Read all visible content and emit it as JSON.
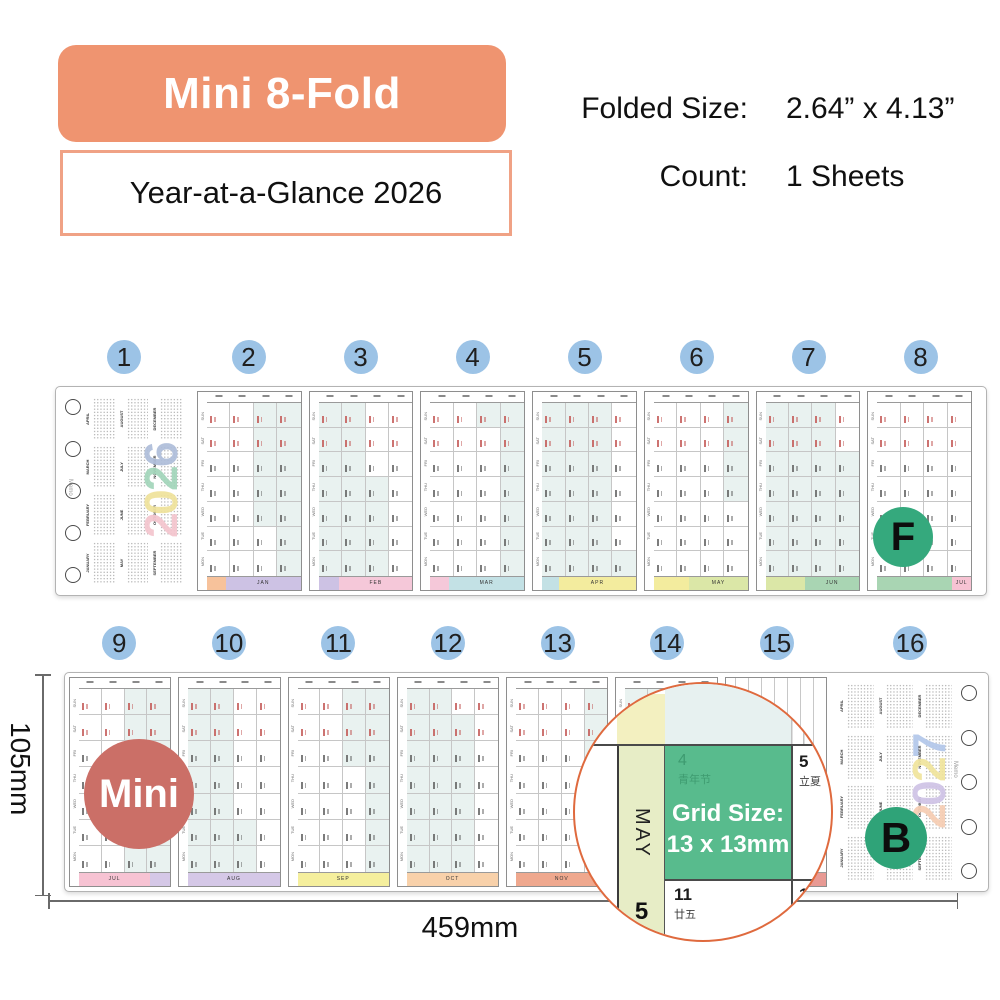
{
  "header": {
    "banner": "Mini 8-Fold",
    "subtitle": "Year-at-a-Glance 2026",
    "specs": [
      {
        "label": "Folded Size:",
        "value": "2.64” x 4.13”"
      },
      {
        "label": "Count:",
        "value": "1 Sheets"
      }
    ]
  },
  "annotations": {
    "product_label": "Mini",
    "dim_width": "459mm",
    "dim_height": "105mm"
  },
  "strips": {
    "front": {
      "side_label": "F",
      "memo": "Memo",
      "panel_numbers": [
        "1",
        "2",
        "3",
        "4",
        "5",
        "6",
        "7",
        "8"
      ],
      "day_labels": [
        "SUN",
        "SAT",
        "FRI",
        "THU",
        "WED",
        "TUE",
        "MON"
      ],
      "cover_year": [
        {
          "digit": "2",
          "color": "#f4c5ce"
        },
        {
          "digit": "0",
          "color": "#efe29b"
        },
        {
          "digit": "2",
          "color": "#a2d5ba"
        },
        {
          "digit": "6",
          "color": "#aebdda"
        }
      ],
      "cover_months": [
        "APRIL",
        "AUGUST",
        "DECEMBER",
        "MARCH",
        "JULY",
        "NOVEMBER",
        "FEBRUARY",
        "JUNE",
        "OCTOBER",
        "JANUARY",
        "MAY",
        "SEPTEMBER"
      ],
      "footers": [
        [
          {
            "c": "#f7c29b",
            "w": 20,
            "t": ""
          },
          {
            "c": "#cdc2e4",
            "w": 80,
            "t": "JAN"
          }
        ],
        [
          {
            "c": "#cdc2e4",
            "w": 22,
            "t": ""
          },
          {
            "c": "#f5c8d9",
            "w": 78,
            "t": "FEB"
          }
        ],
        [
          {
            "c": "#f5c8d9",
            "w": 20,
            "t": ""
          },
          {
            "c": "#c3e1e5",
            "w": 80,
            "t": "MAR"
          }
        ],
        [
          {
            "c": "#c3e1e5",
            "w": 18,
            "t": ""
          },
          {
            "c": "#f3ec9e",
            "w": 82,
            "t": "APR"
          }
        ],
        [
          {
            "c": "#f3ec9e",
            "w": 38,
            "t": ""
          },
          {
            "c": "#dbe7a7",
            "w": 62,
            "t": "MAY"
          }
        ],
        [
          {
            "c": "#dbe7a7",
            "w": 42,
            "t": ""
          },
          {
            "c": "#a9d5b3",
            "w": 58,
            "t": "JUN"
          }
        ],
        [
          {
            "c": "#a9d5b3",
            "w": 80,
            "t": ""
          },
          {
            "c": "#f7c3d3",
            "w": 20,
            "t": "JUL"
          }
        ]
      ]
    },
    "back": {
      "side_label": "B",
      "memo": "Memo",
      "panel_numbers": [
        "9",
        "10",
        "11",
        "12",
        "13",
        "14",
        "15",
        "16"
      ],
      "day_labels": [
        "SUN",
        "SAT",
        "FRI",
        "THU",
        "WED",
        "TUE",
        "MON"
      ],
      "cover_year": [
        {
          "digit": "2",
          "color": "#f6cdb2"
        },
        {
          "digit": "0",
          "color": "#cfc3e6"
        },
        {
          "digit": "2",
          "color": "#f0e49c"
        },
        {
          "digit": "7",
          "color": "#b3c7ea"
        }
      ],
      "cover_months": [
        "APRIL",
        "AUGUST",
        "DECEMBER",
        "MARCH",
        "JULY",
        "NOVEMBER",
        "FEBRUARY",
        "JUNE",
        "OCTOBER",
        "JANUARY",
        "MAY",
        "SEPTEMBER"
      ],
      "footers": [
        [
          {
            "c": "#f7c3d3",
            "w": 78,
            "t": "JUL"
          },
          {
            "c": "#d5c8e7",
            "w": 22,
            "t": ""
          }
        ],
        [
          {
            "c": "#d5c8e7",
            "w": 100,
            "t": "AUG"
          }
        ],
        [
          {
            "c": "#f5ef9d",
            "w": 100,
            "t": "SEP"
          }
        ],
        [
          {
            "c": "#f8d1aa",
            "w": 100,
            "t": "OCT"
          }
        ],
        [
          {
            "c": "#efa88e",
            "w": 100,
            "t": "NOV"
          }
        ],
        [
          {
            "c": "#efa88e",
            "w": 30,
            "t": ""
          },
          {
            "c": "#e89a94",
            "w": 70,
            "t": ""
          }
        ],
        [
          {
            "c": "#e89a94",
            "w": 100,
            "t": ""
          }
        ]
      ]
    }
  },
  "magnifier": {
    "grid_size_line1": "Grid Size:",
    "grid_size_line2": "13 x 13mm",
    "month": "MAY",
    "month_number": "5",
    "highlight_cell": {
      "day": "4",
      "holiday": "青年节"
    },
    "cells": [
      {
        "day": "5",
        "note": "立夏"
      },
      {
        "day": "11",
        "note": "廿五"
      },
      {
        "day": "12",
        "note": "廿六"
      }
    ]
  }
}
